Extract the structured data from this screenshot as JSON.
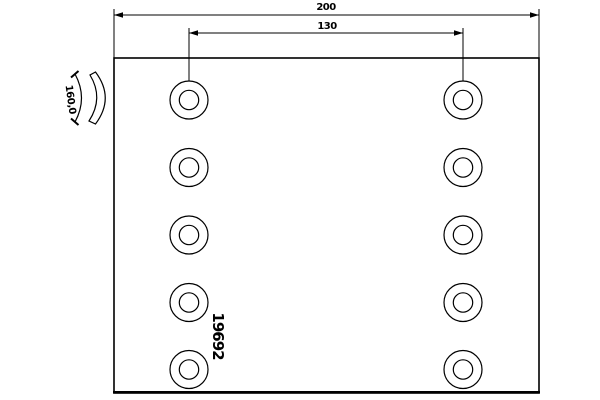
{
  "drawing": {
    "labels": {
      "total_length": "200",
      "hole_spacing": "130",
      "arc_width": "160,0",
      "part_number": "19692"
    },
    "holes": {
      "columns": 2,
      "rows": 5,
      "count": 10
    },
    "colors": {
      "line": "#000000",
      "background": "#ffffff",
      "text": "#000000"
    }
  }
}
